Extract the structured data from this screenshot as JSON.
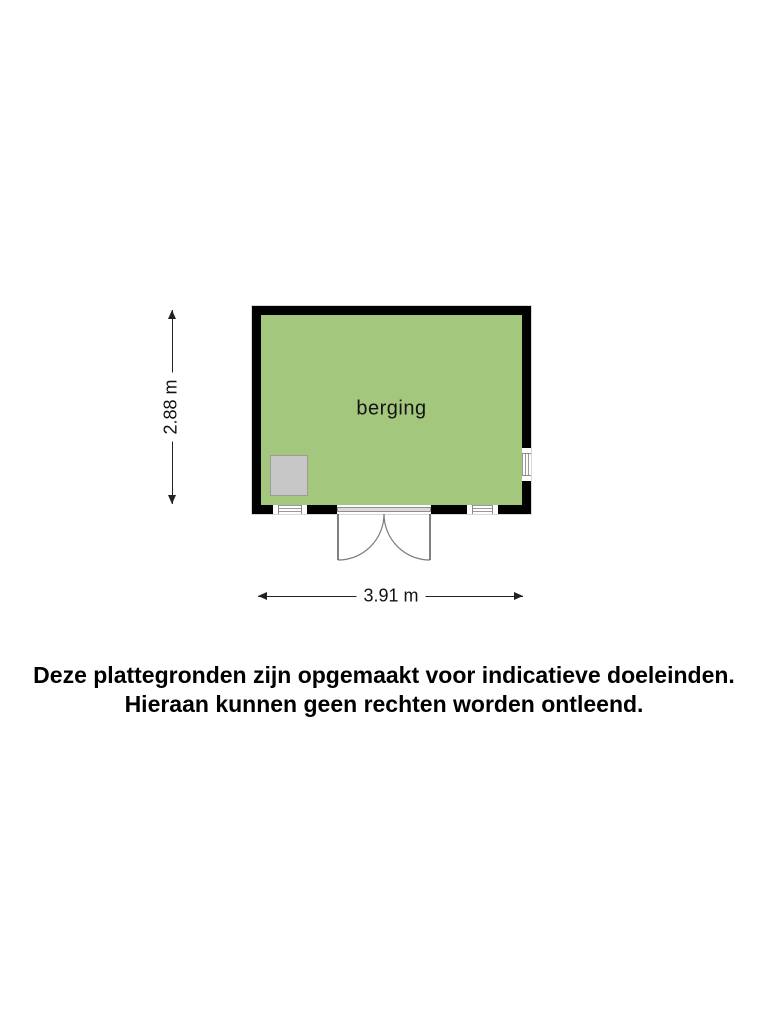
{
  "floorplan": {
    "room_label": "berging",
    "vertical_dimension": "2.88 m",
    "horizontal_dimension": "3.91 m",
    "colors": {
      "room_fill": "#A4C77E",
      "wall": "#000000",
      "fixture": "#C7C7C7",
      "window_frame": "#8A8A8A"
    }
  },
  "disclaimer": {
    "line1": "Deze plattegronden zijn opgemaakt voor indicatieve doeleinden.",
    "line2": "Hieraan kunnen geen rechten worden ontleend."
  }
}
